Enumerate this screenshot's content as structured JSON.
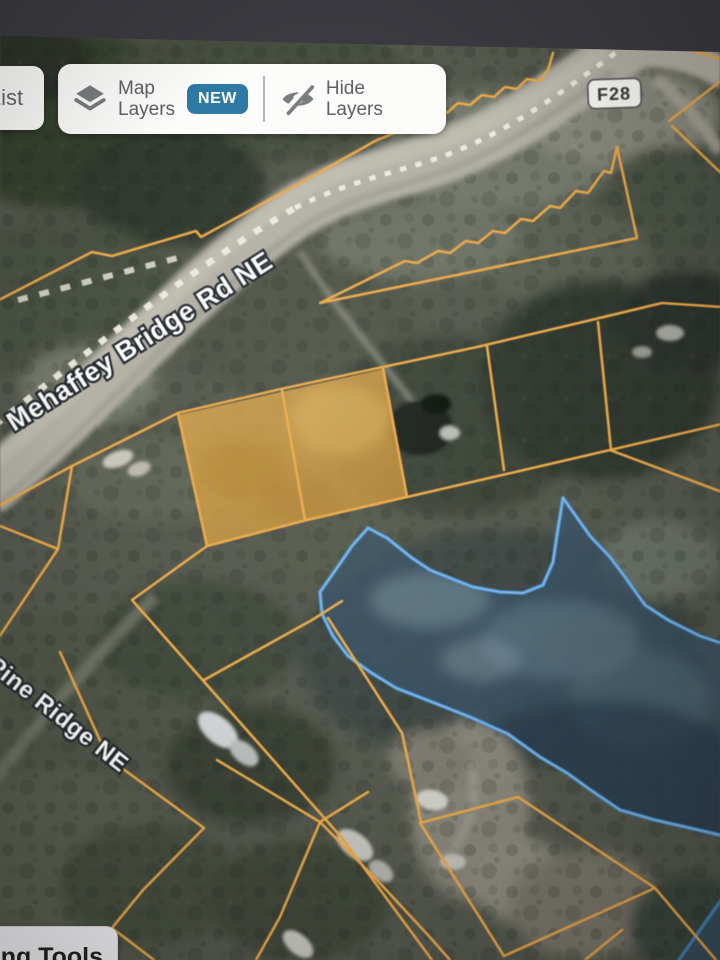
{
  "toolbar": {
    "list_label": "List",
    "map_layers_line1": "Map",
    "map_layers_line2": "Layers",
    "new_badge": "NEW",
    "hide_layers_line1": "Hide",
    "hide_layers_line2": "Layers"
  },
  "map": {
    "route_shield": "F28",
    "road_label_main": "Mehaffey Bridge Rd NE",
    "road_label_secondary": "Pine Ridge NE",
    "colors": {
      "parcel_line": "#efa942",
      "parcel_highlight_fill": "#d79a35",
      "water_outline": "#4597dc",
      "water_inner_outline": "#a9cdec",
      "water_fill": "#3a5468",
      "new_badge_bg": "#2e7aa5",
      "road_surface": "#b4b1a5",
      "centerline_dash": "#eeece2"
    }
  },
  "bottom_toolbar": {
    "tools_label": "ng Tools"
  }
}
